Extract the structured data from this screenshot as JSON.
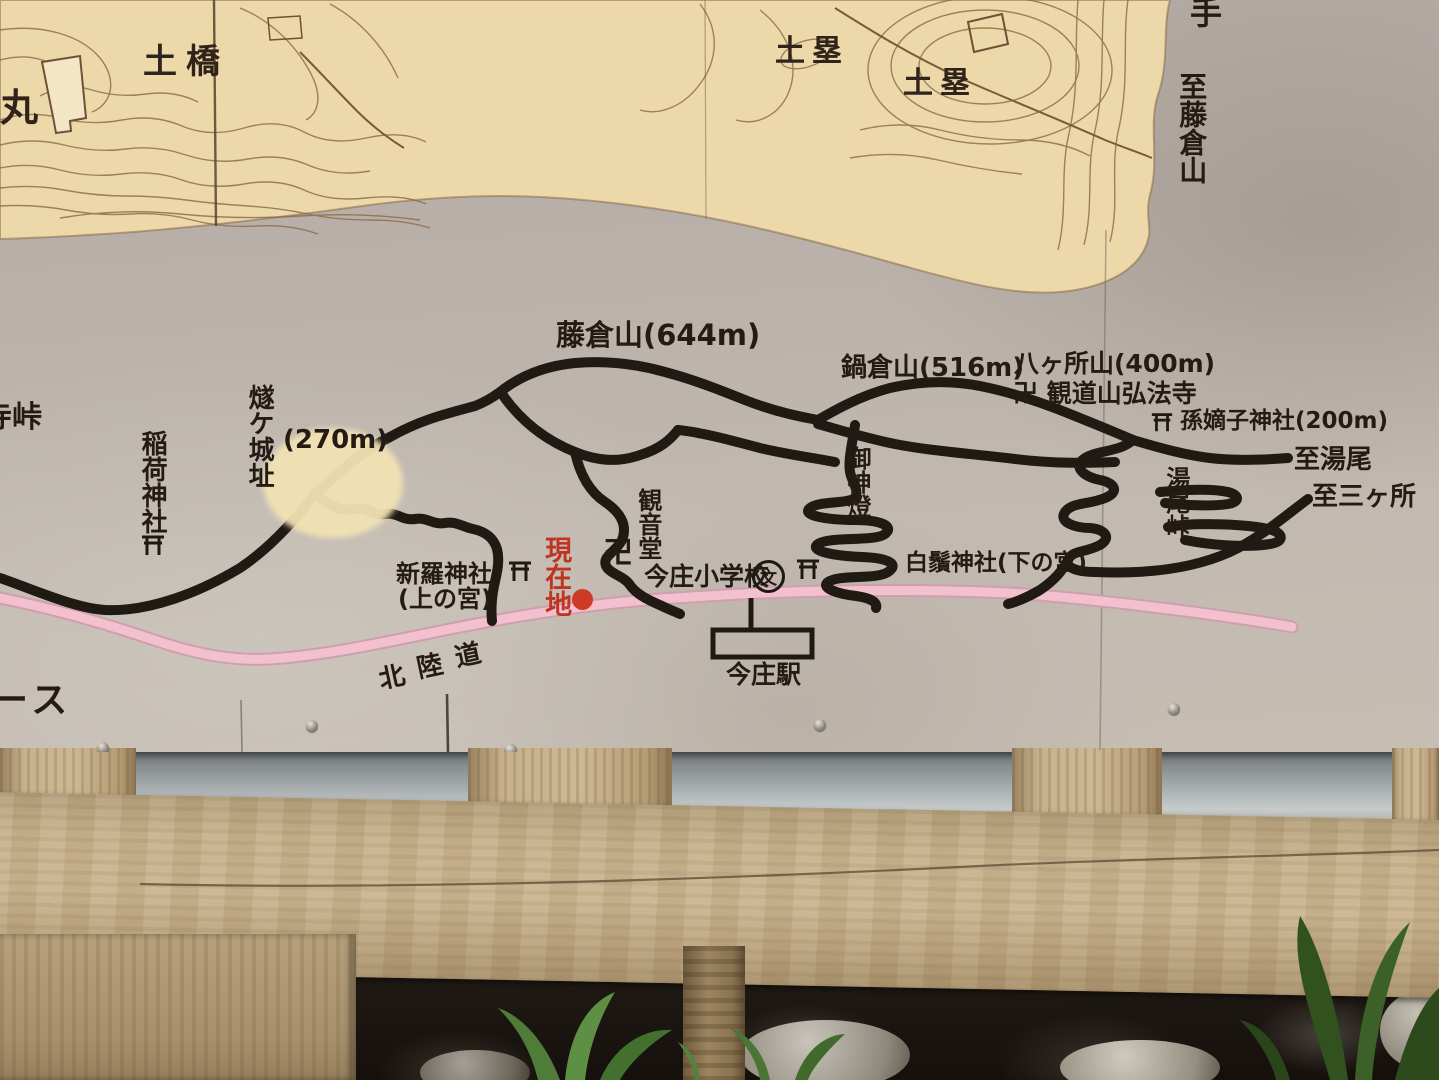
{
  "colors": {
    "topo_cream": "#ecd8a8",
    "panel_gray": "#bab2aa",
    "contour_brown": "#8a6a48",
    "trail_black": "#201a14",
    "road_pink": "#f3c0cd",
    "current_location_red": "#bf3522",
    "wood_tan": "#c8b28c"
  },
  "sign": {
    "topo_area": {
      "tsuchibashi": "土橋",
      "maru": "丸",
      "dorui_left": "土塁",
      "dorui_right": "土塁",
      "karamete": "手",
      "to_fujikurayama": "至藤倉山"
    },
    "peaks": {
      "fujikurayama": "藤倉山(644m)",
      "nabekurayama": "鍋倉山(516m)",
      "hakkashoyama": "八ヶ所山(400m)"
    },
    "shrines": {
      "kobodera": "卍 観道山弘法寺",
      "magojakushi": "孫嫡子神社(200m)",
      "shirahige": "白鬚神社(下の宮)",
      "shinra": "新羅神社",
      "shinra_sub": "(上の宮)",
      "inari": "稲荷神社",
      "kannondo": "観音堂",
      "manji": "卍",
      "goshinto": "御神燈"
    },
    "places": {
      "hiuchijo": "燧ケ城址",
      "hiuchijo_alt": "(270m)",
      "toge_partial": "寺峠",
      "yunoo_toge": "湯尾峠",
      "to_yunoo": "至湯尾",
      "to_sangasho": "至三ヶ所",
      "imajo_school": "今庄小学校",
      "school_mark": "文",
      "imajo_station": "今庄駅",
      "hokurikudo": [
        "北",
        "陸",
        "道"
      ],
      "course_partial": "ース",
      "genzaichi": "現在地"
    }
  }
}
